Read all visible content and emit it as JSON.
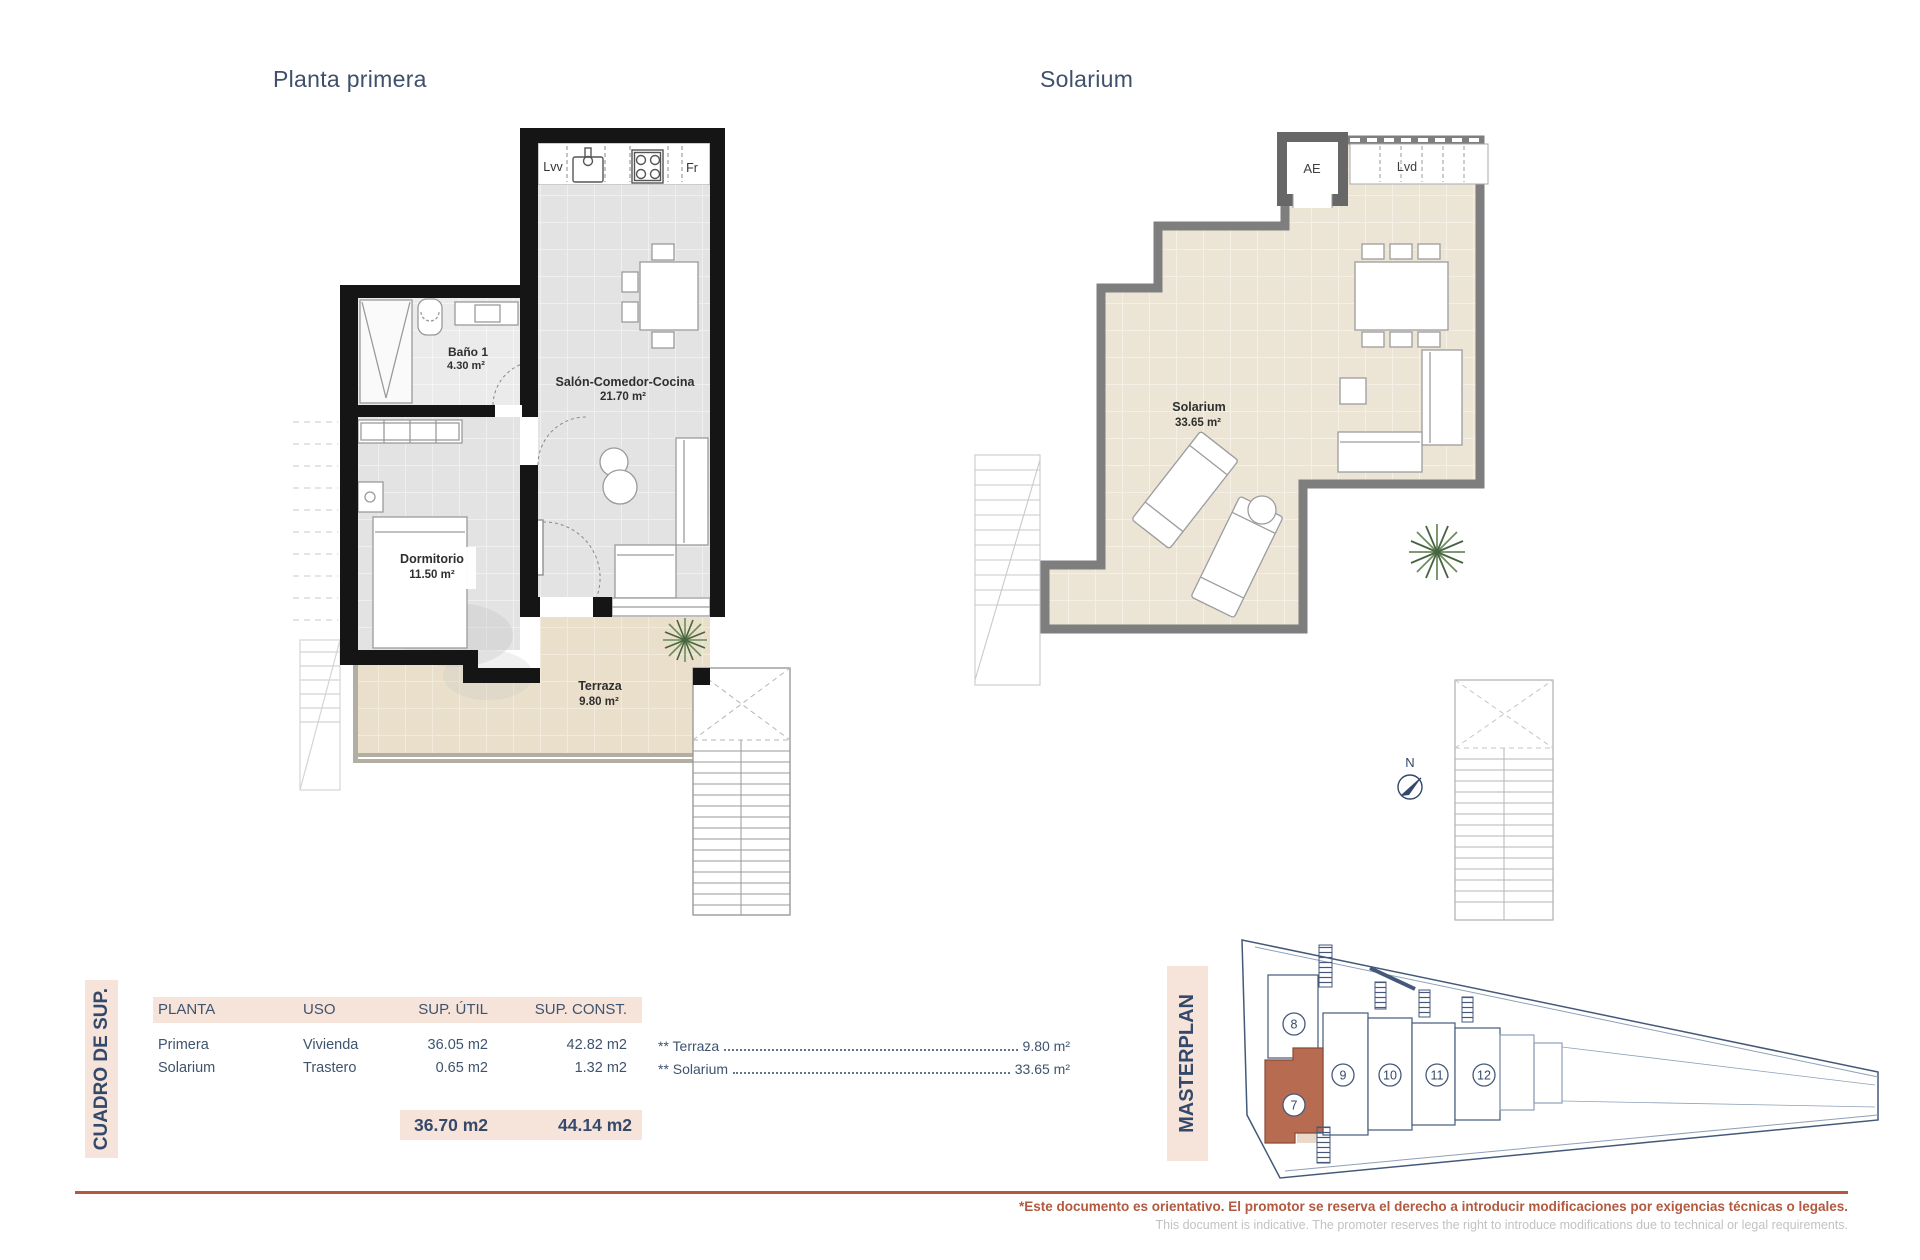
{
  "titles": {
    "plan1": "Planta primera",
    "plan2": "Solarium"
  },
  "plan1": {
    "kitchen_left": "Lvv",
    "kitchen_right": "Fr",
    "bano_name": "Baño 1",
    "bano_area": "4.30 m²",
    "salon_name": "Salón-Comedor-Cocina",
    "salon_area": "21.70 m²",
    "dorm_name": "Dormitorio",
    "dorm_area": "11.50 m²",
    "terraza_name": "Terraza",
    "terraza_area": "9.80 m²"
  },
  "plan2": {
    "ae": "AE",
    "lvd": "Lvd",
    "name": "Solarium",
    "area": "33.65 m²"
  },
  "summary": {
    "side_label": "CUADRO DE SUP.",
    "col_planta": "PLANTA",
    "col_uso": "USO",
    "col_util": "SUP. ÚTIL",
    "col_const": "SUP. CONST.",
    "rows": [
      {
        "planta": "Primera",
        "uso": "Vivienda",
        "util": "36.05 m2",
        "const": "42.82 m2"
      },
      {
        "planta": "Solarium",
        "uso": "Trastero",
        "util": "0.65 m2",
        "const": "1.32 m2"
      }
    ],
    "total_util": "36.70 m2",
    "total_const": "44.14 m2",
    "extras": [
      {
        "label": "** Terraza",
        "value": "9.80 m²"
      },
      {
        "label": "** Solarium",
        "value": "33.65 m²"
      }
    ]
  },
  "masterplan": {
    "side_label": "MASTERPLAN",
    "north": "N",
    "units": [
      "8",
      "9",
      "10",
      "11",
      "12"
    ],
    "highlight": "7"
  },
  "footer": {
    "es": "*Este documento es orientativo. El promotor se reserva el derecho a introducir modificaciones por exigencias técnicas o legales.",
    "en": "This document is indicative. The promoter reserves the right to introduce modifications due to technical or legal requirements."
  },
  "colors": {
    "accent": "#b2593f",
    "heading": "#3e506b",
    "pink": "#f6e3da",
    "unit7": "#b76c52"
  }
}
